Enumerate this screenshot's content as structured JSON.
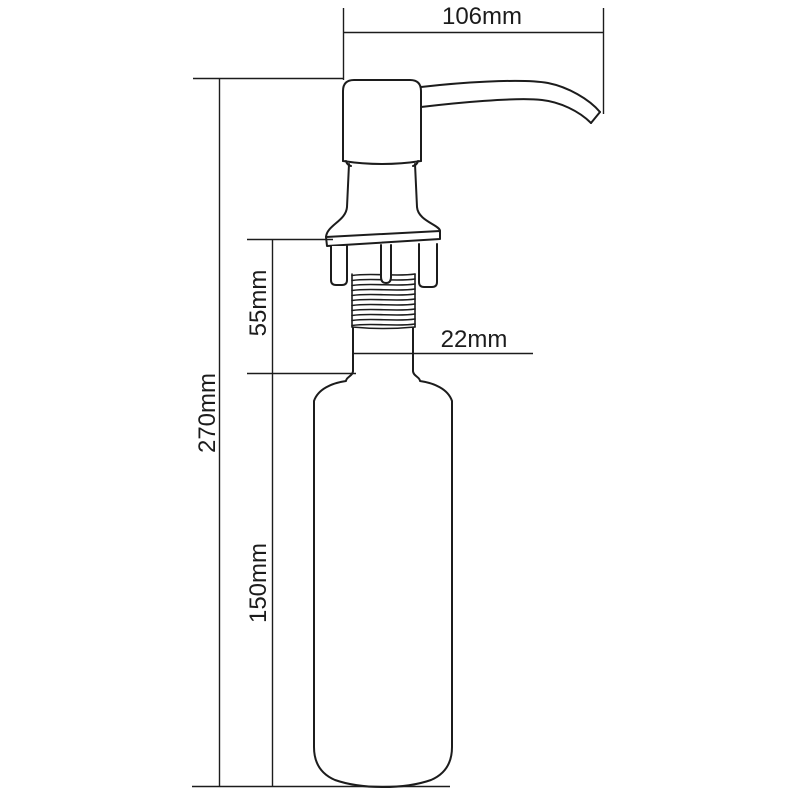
{
  "drawing": {
    "subject": "deck-mounted soap dispenser pump - dimensioned technical drawing",
    "background_color": "#ffffff",
    "line_color": "#1c1c1c",
    "units": "mm",
    "dimensions": {
      "spout_reach": {
        "label": "106mm",
        "orientation": "horizontal",
        "measures": "pump head to spout tip width"
      },
      "overall_height": {
        "label": "270mm",
        "orientation": "vertical",
        "measures": "total height of dispenser"
      },
      "shank_height": {
        "label": "55mm",
        "orientation": "vertical",
        "measures": "flange and threaded shank section height"
      },
      "bottle_height": {
        "label": "150mm",
        "orientation": "vertical",
        "measures": "bottle height"
      },
      "neck_diameter": {
        "label": "22mm",
        "orientation": "horizontal",
        "measures": "neck tube diameter"
      }
    }
  }
}
